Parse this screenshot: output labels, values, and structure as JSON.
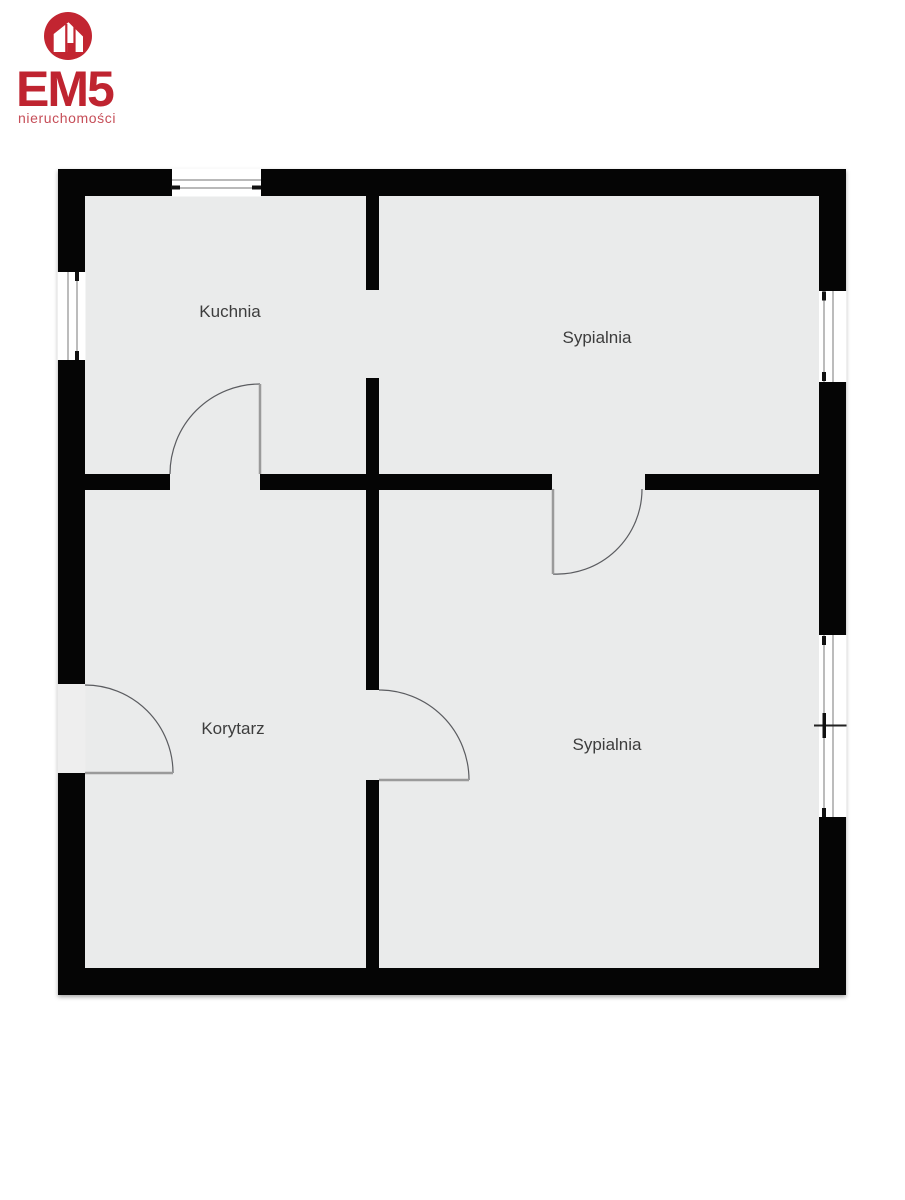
{
  "logo": {
    "brand": "EM5",
    "tagline": "nieruchomości",
    "colors": {
      "brand_red": "#bf2430",
      "tagline_red": "#c64e58",
      "circle_red": "#c22531",
      "house_white": "#ffffff"
    },
    "icon": "house-in-circle-icon"
  },
  "floorplan": {
    "colors": {
      "wall": "#050505",
      "floor": "#eaebeb",
      "window_frame": "#8f8f8f",
      "door_arc": "#5b5c60",
      "door_leaf": "#9a9a9a",
      "label": "#3d3d3d",
      "background": "#ffffff"
    },
    "rooms": [
      {
        "id": "kuchnia",
        "name": "Kuchnia"
      },
      {
        "id": "sypialnia-gorna",
        "name": "Sypialnia"
      },
      {
        "id": "korytarz",
        "name": "Korytarz"
      },
      {
        "id": "sypialnia-dolna",
        "name": "Sypialnia"
      }
    ]
  }
}
